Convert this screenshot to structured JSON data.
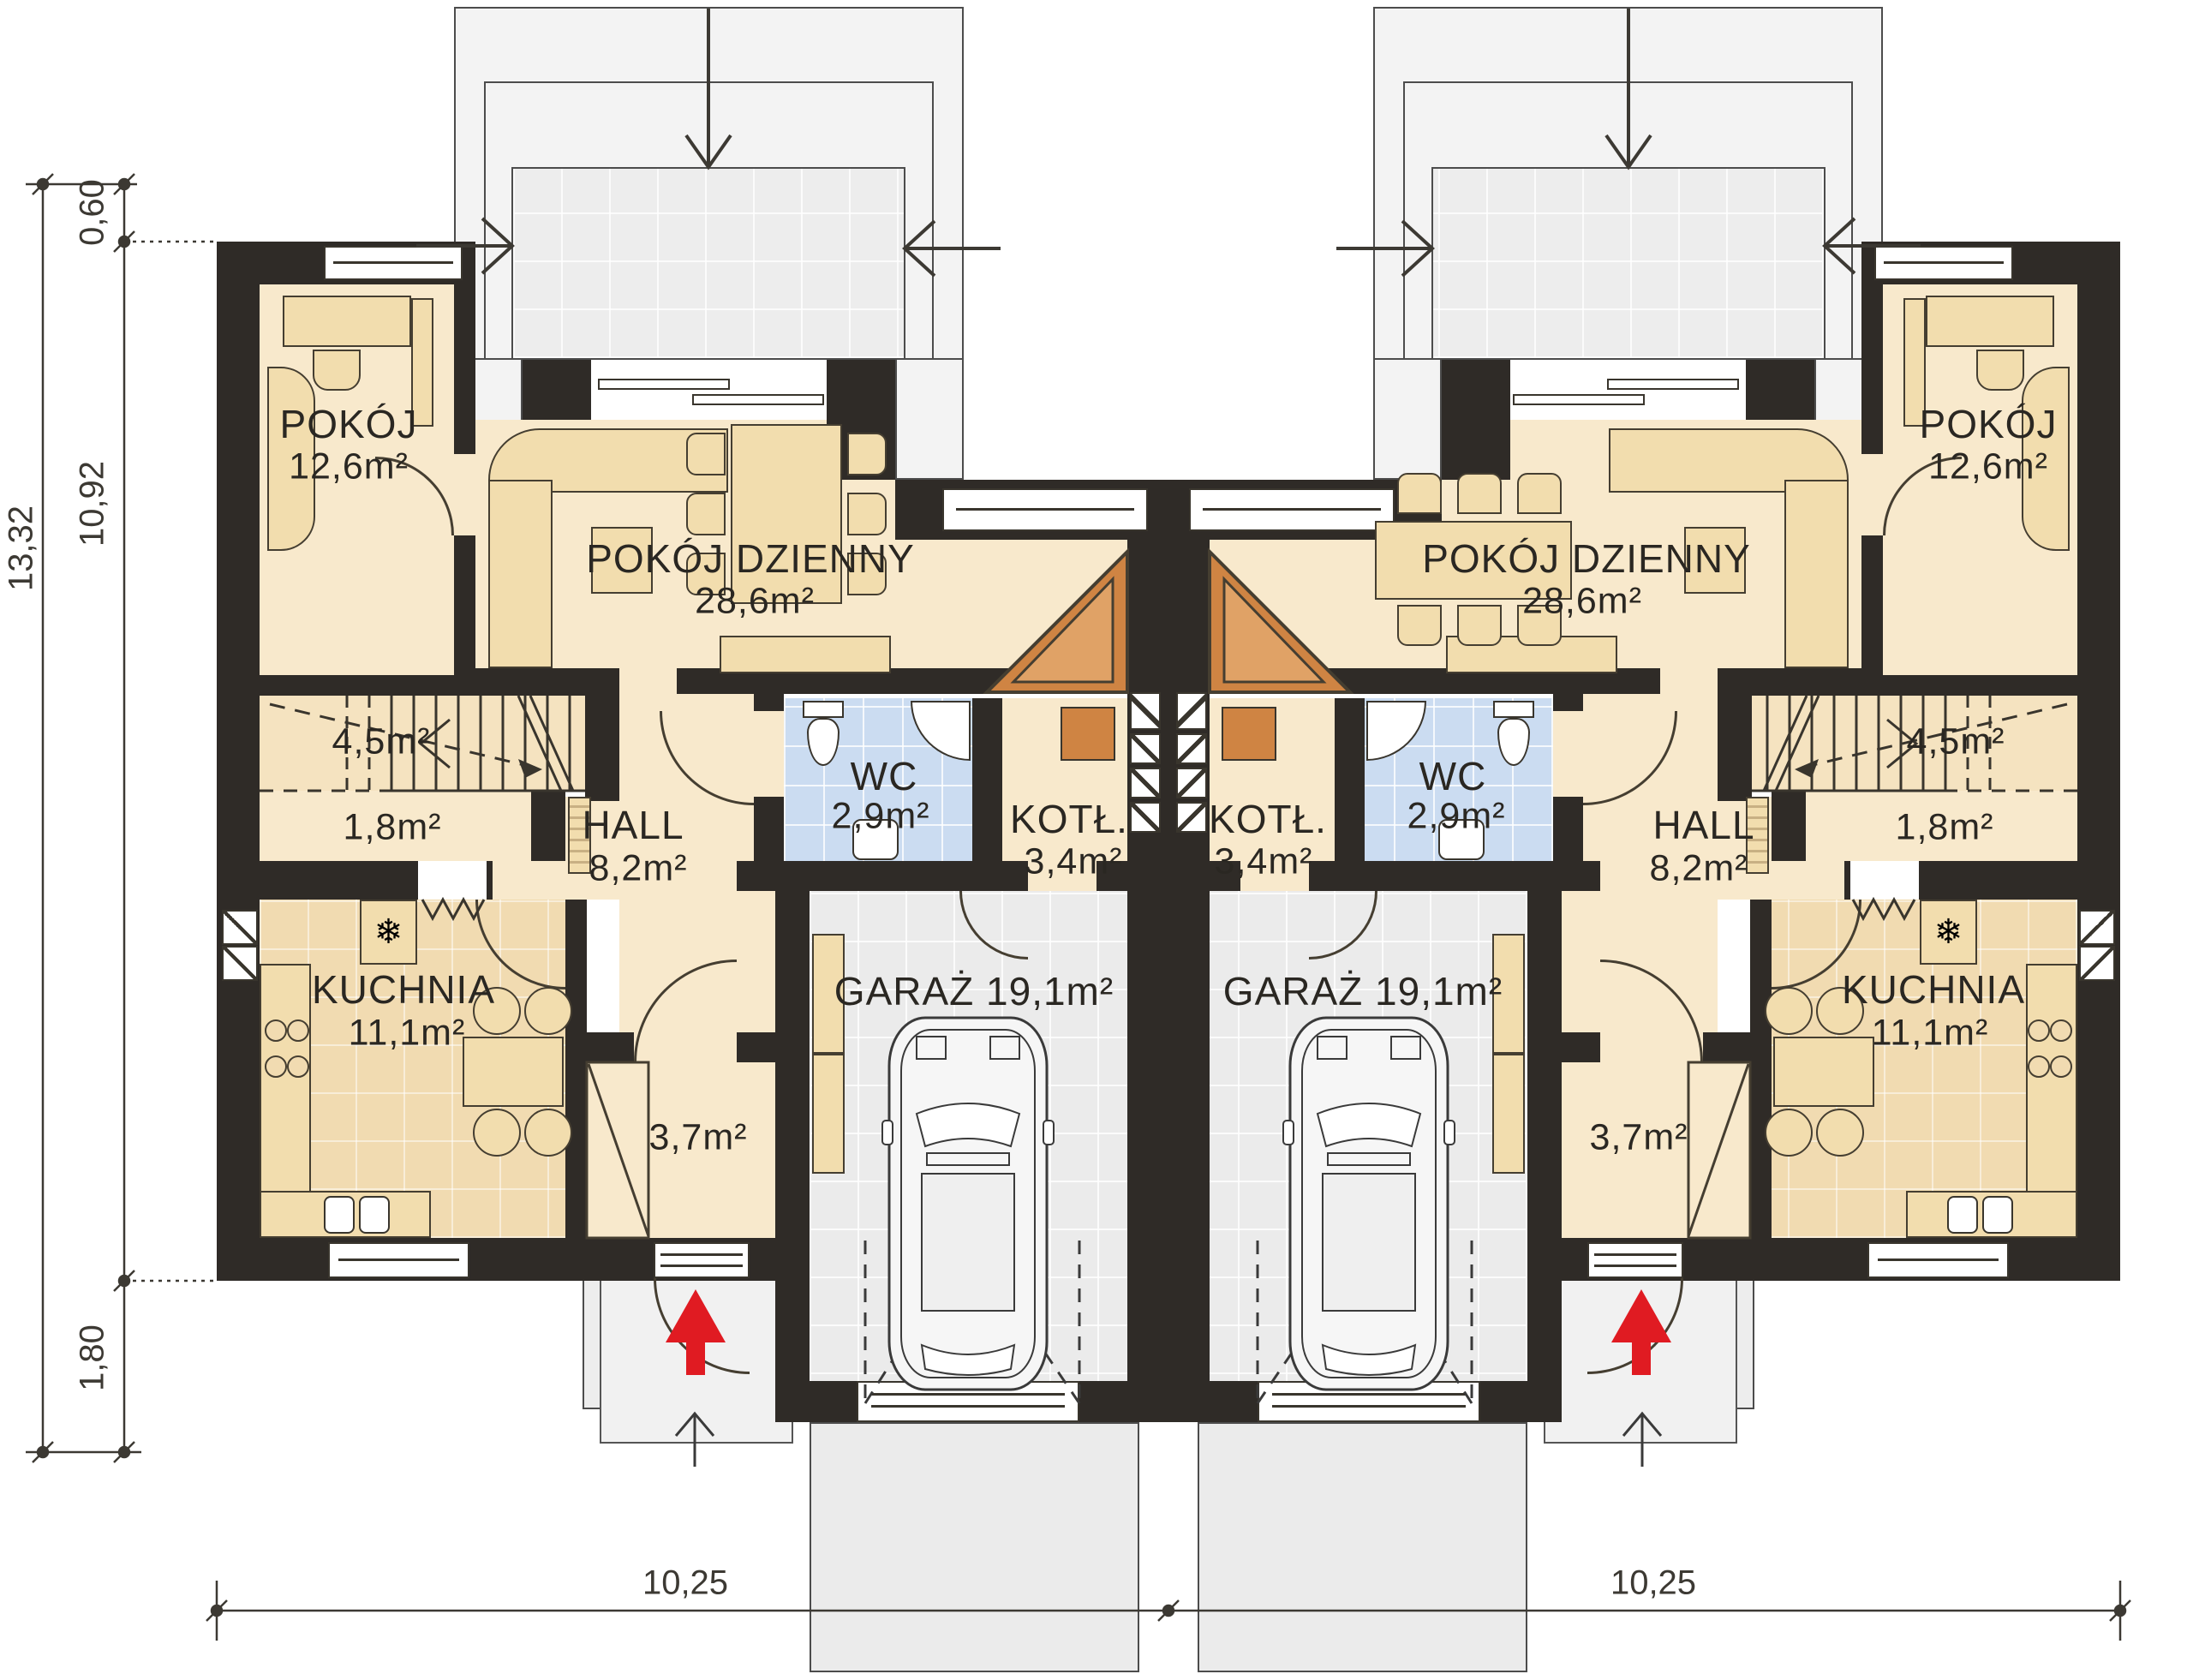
{
  "units": {
    "left": {
      "pokoj": {
        "name": "POKÓJ",
        "area": "12,6m²"
      },
      "living": {
        "name": "POKÓJ DZIENNY",
        "area": "28,6m²"
      },
      "hall": {
        "name": "HALL",
        "area": "8,2m²"
      },
      "wc": {
        "name": "WC",
        "area": "2,9m²"
      },
      "boiler": {
        "name": "KOTŁ.",
        "area": "3,4m²"
      },
      "garage": {
        "label": "GARAŻ 19,1m²"
      },
      "kitchen": {
        "name": "KUCHNIA",
        "area": "11,1m²"
      },
      "wardrobe": {
        "area": "3,7m²"
      },
      "stairs": {
        "area": "4,5m²"
      },
      "closet": {
        "area": "1,8m²"
      },
      "fridge_icon": "❄"
    },
    "right": {
      "pokoj": {
        "name": "POKÓJ",
        "area": "12,6m²"
      },
      "living": {
        "name": "POKÓJ DZIENNY",
        "area": "28,6m²"
      },
      "hall": {
        "name": "HALL",
        "area": "8,2m²"
      },
      "wc": {
        "name": "WC",
        "area": "2,9m²"
      },
      "boiler": {
        "name": "KOTŁ.",
        "area": "3,4m²"
      },
      "garage": {
        "label": "GARAŻ 19,1m²"
      },
      "kitchen": {
        "name": "KUCHNIA",
        "area": "11,1m²"
      },
      "wardrobe": {
        "area": "3,7m²"
      },
      "stairs": {
        "area": "4,5m²"
      },
      "closet": {
        "area": "1,8m²"
      },
      "fridge_icon": "❄"
    }
  },
  "dimensions": {
    "total_height": "13,32",
    "terrace_offset": "0,60",
    "main_height": "10,92",
    "porch_depth": "1,80",
    "width_left": "10,25",
    "width_right": "10,25"
  },
  "colors": {
    "wall": "#2f2b27",
    "floor": "#f8e9cc",
    "kitchen_floor": "#f1dbb1",
    "wc_floor": "#cbdcf1",
    "garage_floor": "#ebebeb",
    "furniture": "#f2ddae",
    "fireplace": "#cf8443",
    "entry_arrow": "#e01b22"
  }
}
